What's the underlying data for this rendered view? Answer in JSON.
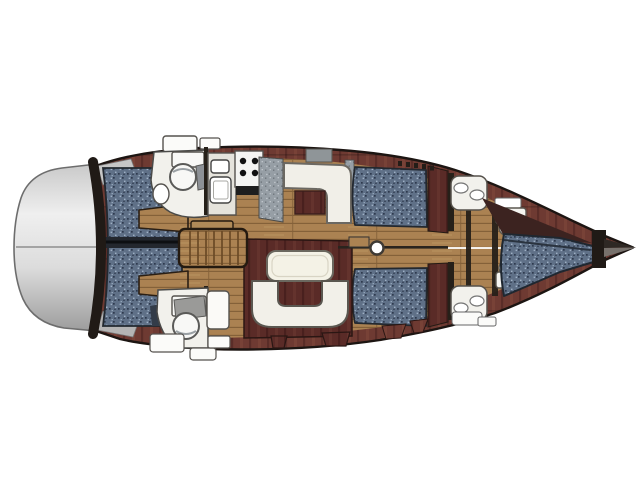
{
  "image": {
    "kind": "yacht-interior-layout-plan",
    "orientation": "bow-right-stern-left"
  },
  "parts": {
    "plan": "sailing yacht interior layout plan",
    "stern_platform": "stern swim platform",
    "transom_wall": "transom bulkhead",
    "hull": "hull and mahogany deck trim",
    "floor": "teak cabin sole",
    "aft_berth": "aft cabin double berth",
    "aft_berth_steps": "aft berth side steps",
    "head_aft_top": "aft head with toilet and basin (port)",
    "head_aft_bottom": "aft head with toilet and basin (starboard)",
    "galley": "galley with sinks, stove and worktop",
    "stove": "four-burner stove",
    "sinks": "galley twin sinks",
    "counter": "galley worktop",
    "l_settee": "L-shaped settee with table",
    "sofa_top": "salon settee (port)",
    "sofa_bottom": "salon settee (starboard)",
    "dinette": "U-shaped dinette with table",
    "dinette_table": "dinette table",
    "steps": "companionway steps",
    "mast": "mast at centerline",
    "fwd_head_top": "forward head with basins and toilet (port)",
    "fwd_head_bottom": "forward head with basins and toilet (starboard)",
    "v_berth": "forward V-berth",
    "bow_stem": "bow stem fitting"
  },
  "colors": {
    "background": "#ffffff",
    "outline": "#1c1512",
    "hull_wood": "#6e3a32",
    "hull_wood_dark": "#5a2b27",
    "floor_wood": "#ab8252",
    "floor_seam": "#7e5c35",
    "steps_wood": "#b08a58",
    "upholstery": "#5f7087",
    "upholstery_dark": "#2e3a4e",
    "upholstery_light": "#9fb0c4",
    "fixture_white": "#f2f1ec",
    "fixture_outline": "#53504a",
    "table_white": "#f4f2e6",
    "counter_gray": "#969ea5",
    "transom_light": "#efefef",
    "transom_dark": "#9d9d9d",
    "stem_dark": "#201a16",
    "bulkhead_dark": "#262019",
    "mast_white": "#ffffff"
  }
}
